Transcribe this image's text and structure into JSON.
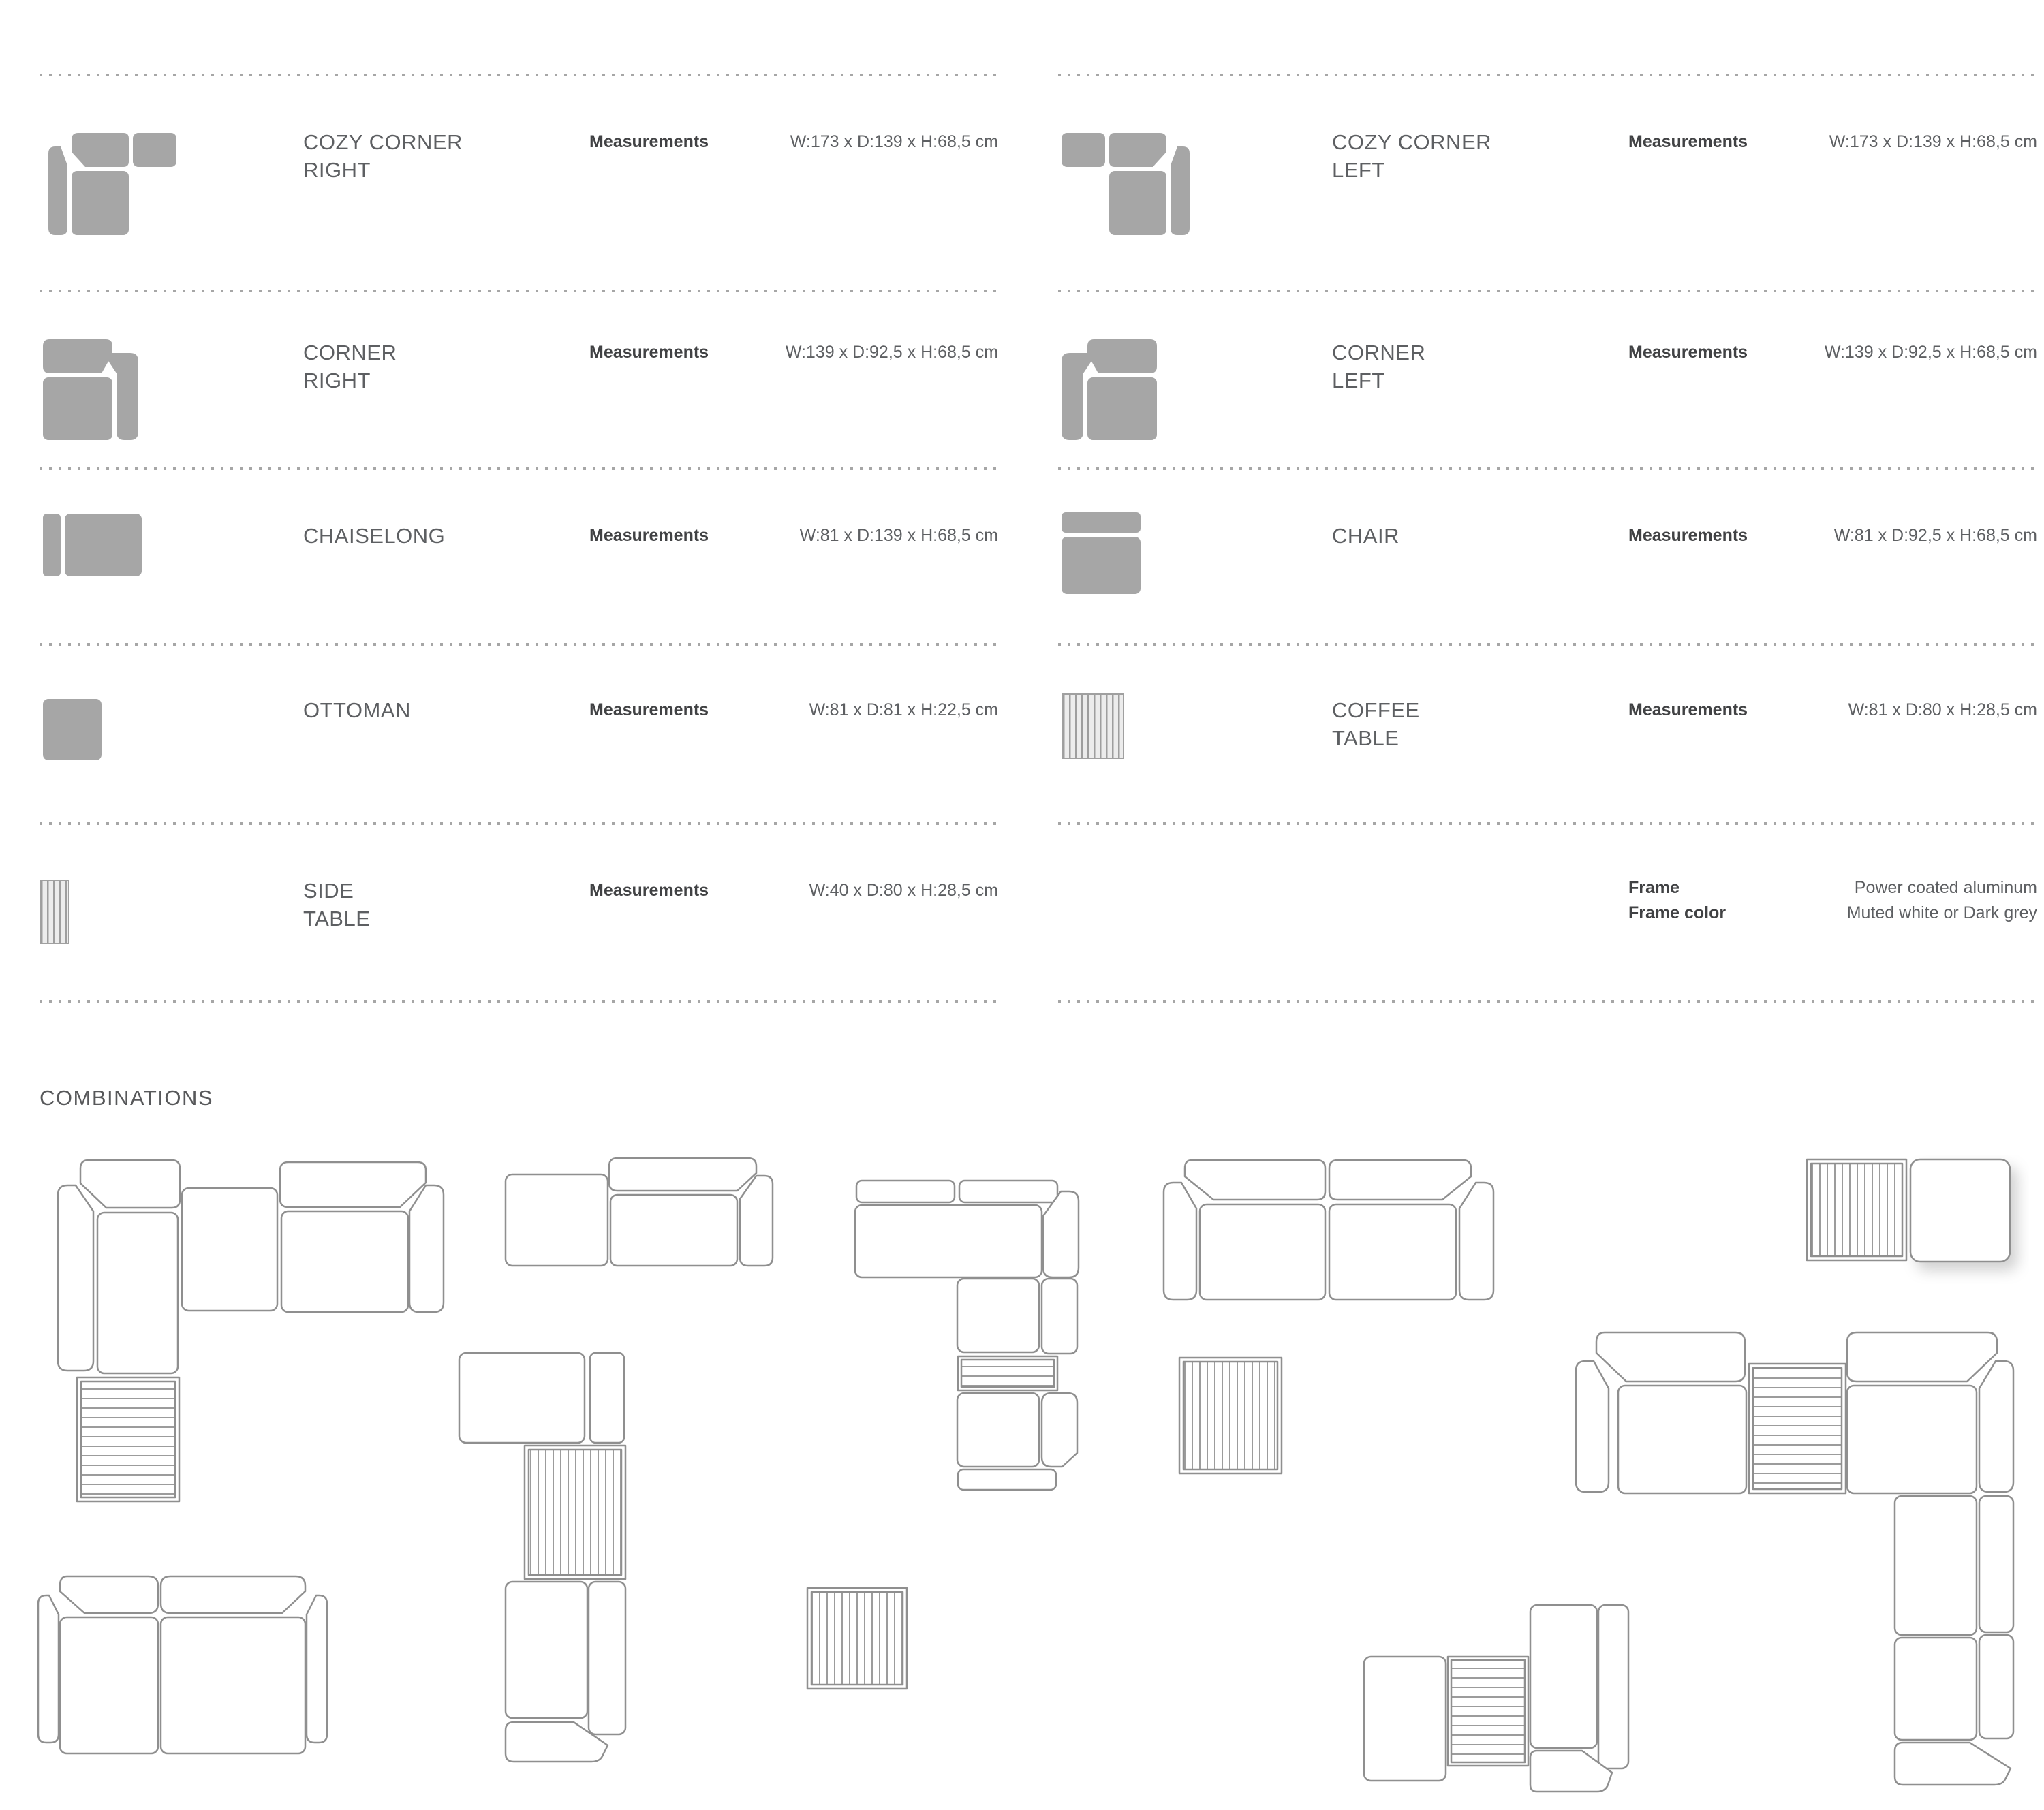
{
  "colors": {
    "icon_gray": "#a6a6a6",
    "outline_gray": "#8f8f8f",
    "text_gray": "#5d5f62",
    "label_dark": "#414244",
    "dot_gray": "#a6a6a6"
  },
  "products": [
    {
      "name_line1": "COZY CORNER",
      "name_line2": "RIGHT",
      "measurements_label": "Measurements",
      "measurements_value": "W:173 x D:139 x H:68,5 cm"
    },
    {
      "name_line1": "COZY CORNER",
      "name_line2": "LEFT",
      "measurements_label": "Measurements",
      "measurements_value": "W:173 x D:139 x H:68,5 cm"
    },
    {
      "name_line1": "CORNER",
      "name_line2": "RIGHT",
      "measurements_label": "Measurements",
      "measurements_value": "W:139 x D:92,5 x H:68,5 cm"
    },
    {
      "name_line1": "CORNER",
      "name_line2": "LEFT",
      "measurements_label": "Measurements",
      "measurements_value": "W:139 x D:92,5 x H:68,5 cm"
    },
    {
      "name_line1": "CHAISELONG",
      "name_line2": "",
      "measurements_label": "Measurements",
      "measurements_value": "W:81 x D:139 x H:68,5 cm"
    },
    {
      "name_line1": "CHAIR",
      "name_line2": "",
      "measurements_label": "Measurements",
      "measurements_value": "W:81 x D:92,5 x H:68,5 cm"
    },
    {
      "name_line1": "OTTOMAN",
      "name_line2": "",
      "measurements_label": "Measurements",
      "measurements_value": "W:81 x D:81 x H:22,5 cm"
    },
    {
      "name_line1": "COFFEE",
      "name_line2": "TABLE",
      "measurements_label": "Measurements",
      "measurements_value": "W:81 x D:80 x H:28,5 cm"
    },
    {
      "name_line1": "SIDE",
      "name_line2": "TABLE",
      "measurements_label": "Measurements",
      "measurements_value": "W:40 x D:80 x H:28,5 cm"
    }
  ],
  "frame": {
    "frame_label": "Frame",
    "frame_value": "Power coated aluminum",
    "frame_color_label": "Frame color",
    "frame_color_value": "Muted white or Dark grey"
  },
  "combinations": {
    "heading": "COMBINATIONS",
    "layouts": [
      {
        "modules": [
          "cozy corner right",
          "chaiselong",
          "coffee table",
          "ottoman",
          "cozy corner left"
        ]
      },
      {
        "modules": [
          "ottoman",
          "cozy corner left"
        ]
      },
      {
        "modules": [
          "chaiselong",
          "chair",
          "coffee table",
          "cozy corner left"
        ]
      },
      {
        "modules": [
          "cozy corner right",
          "corner left",
          "chair",
          "side table",
          "cozy corner left",
          "coffee table"
        ]
      },
      {
        "modules": [
          "cozy corner right",
          "cozy corner left",
          "coffee table"
        ]
      },
      {
        "modules": [
          "coffee table",
          "ottoman"
        ]
      },
      {
        "modules": [
          "cozy corner right",
          "coffee table",
          "cozy corner left",
          "chair",
          "cozy corner left"
        ]
      },
      {
        "modules": [
          "ottoman",
          "coffee table",
          "cozy corner left"
        ]
      },
      {
        "modules": [
          "cozy corner right",
          "cozy corner left"
        ]
      }
    ]
  }
}
